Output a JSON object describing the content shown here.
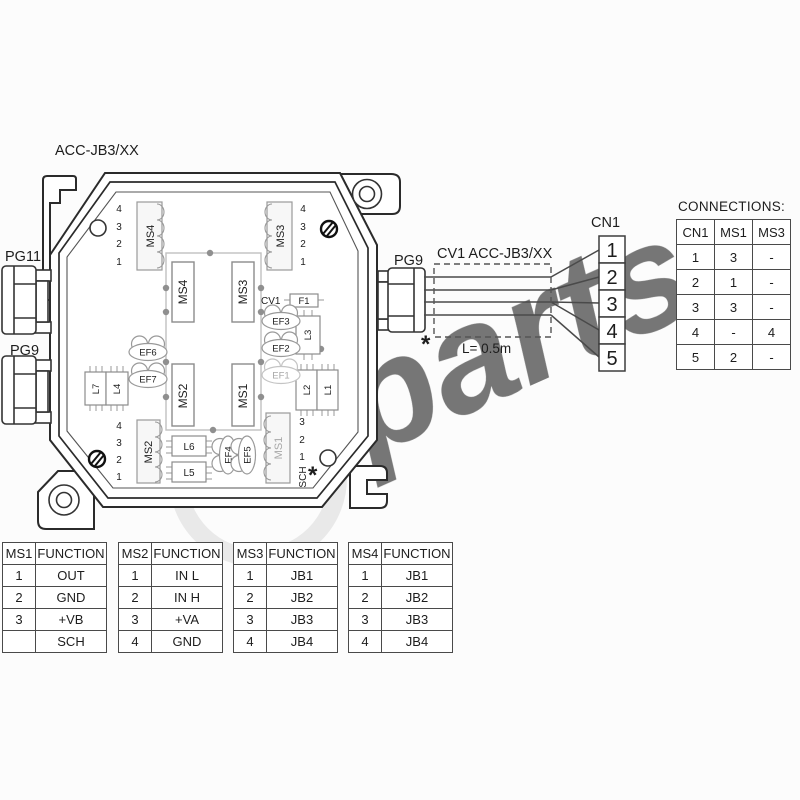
{
  "watermark": {
    "text": "parts"
  },
  "diagram": {
    "title": "ACC-JB3/XX",
    "labels": {
      "pg11": "PG11",
      "pg9_left": "PG9",
      "pg9_right": "PG9",
      "cn1": "CN1",
      "cable": "CV1 ACC-JB3/XX",
      "cable_length": "L= 0.5m",
      "asterisk": "*",
      "cv1": "CV1",
      "f1": "F1",
      "sch": "SCH"
    },
    "connector_blocks": {
      "ms4": "MS4",
      "ms3": "MS3",
      "ms2": "MS2",
      "ms1": "MS1"
    },
    "relays": {
      "ms4": "MS4",
      "ms3": "MS3",
      "ms2": "MS2",
      "ms1": "MS1"
    },
    "inductors": {
      "l1": "L1",
      "l2": "L2",
      "l3": "L3",
      "l4": "L4",
      "l5": "L5",
      "l6": "L6",
      "l7": "L7"
    },
    "ferrites": {
      "ef1": "EF1",
      "ef2": "EF2",
      "ef3": "EF3",
      "ef4": "EF4",
      "ef5": "EF5",
      "ef6": "EF6",
      "ef7": "EF7"
    },
    "pin_numbers": [
      "1",
      "2",
      "3",
      "4"
    ],
    "cn1_pins": [
      "1",
      "2",
      "3",
      "4",
      "5"
    ],
    "ms1_pin_labels": [
      "3",
      "2",
      "1"
    ]
  },
  "connections_table": {
    "title": "CONNECTIONS:",
    "headers": [
      "CN1",
      "MS1",
      "MS3"
    ],
    "rows": [
      [
        "1",
        "3",
        "-"
      ],
      [
        "2",
        "1",
        "-"
      ],
      [
        "3",
        "3",
        "-"
      ],
      [
        "4",
        "-",
        "4"
      ],
      [
        "5",
        "2",
        "-"
      ]
    ]
  },
  "function_tables": [
    {
      "name": "MS1",
      "function_label": "FUNCTION",
      "rows": [
        [
          "1",
          "OUT"
        ],
        [
          "2",
          "GND"
        ],
        [
          "3",
          "+VB"
        ],
        [
          "",
          "SCH"
        ]
      ]
    },
    {
      "name": "MS2",
      "function_label": "FUNCTION",
      "rows": [
        [
          "1",
          "IN L"
        ],
        [
          "2",
          "IN H"
        ],
        [
          "3",
          "+VA"
        ],
        [
          "4",
          "GND"
        ]
      ]
    },
    {
      "name": "MS3",
      "function_label": "FUNCTION",
      "rows": [
        [
          "1",
          "JB1"
        ],
        [
          "2",
          "JB2"
        ],
        [
          "3",
          "JB3"
        ],
        [
          "4",
          "JB4"
        ]
      ]
    },
    {
      "name": "MS4",
      "function_label": "FUNCTION",
      "rows": [
        [
          "1",
          "JB1"
        ],
        [
          "2",
          "JB2"
        ],
        [
          "3",
          "JB3"
        ],
        [
          "4",
          "JB4"
        ]
      ]
    }
  ]
}
